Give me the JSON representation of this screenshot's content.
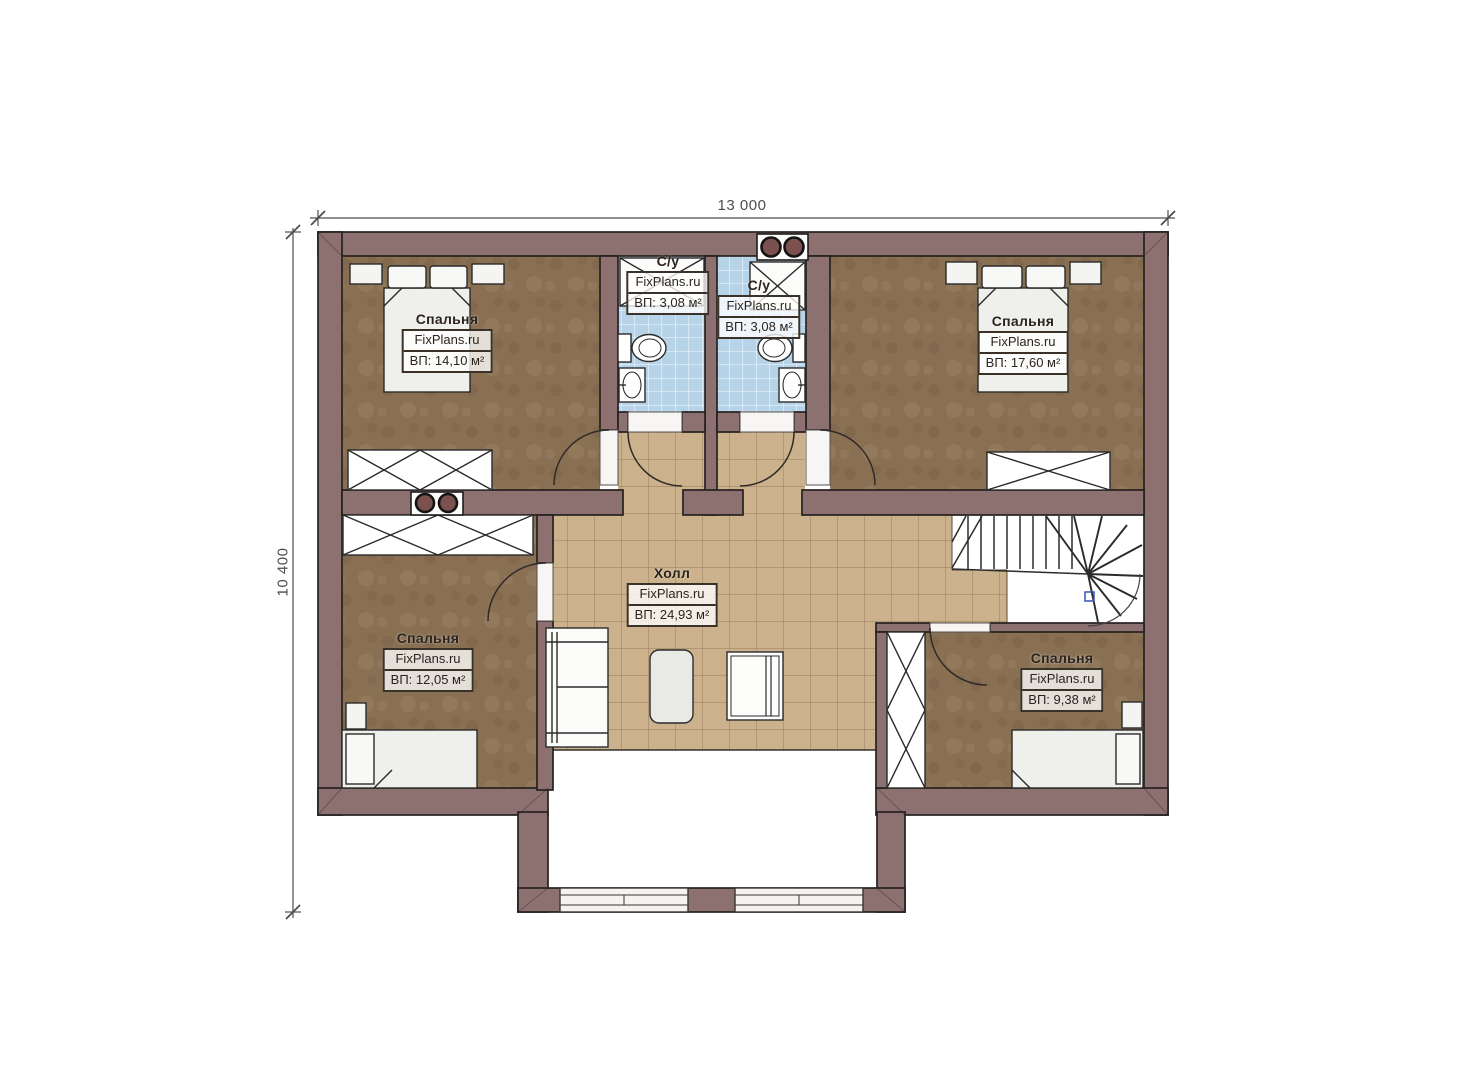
{
  "dimensions": {
    "width": "13 000",
    "height": "10 400"
  },
  "rooms": [
    {
      "id": "bedroom-top-left",
      "name": "Спальня",
      "brand": "FixPlans.ru",
      "area": "ВП: 14,10 м²"
    },
    {
      "id": "bathroom-left",
      "name": "С/у",
      "brand": "FixPlans.ru",
      "area": "ВП: 3,08 м²"
    },
    {
      "id": "bathroom-right",
      "name": "С/у",
      "brand": "FixPlans.ru",
      "area": "ВП: 3,08 м²"
    },
    {
      "id": "bedroom-top-right",
      "name": "Спальня",
      "brand": "FixPlans.ru",
      "area": "ВП: 17,60 м²"
    },
    {
      "id": "hall",
      "name": "Холл",
      "brand": "FixPlans.ru",
      "area": "ВП: 24,93 м²"
    },
    {
      "id": "bedroom-bottom-left",
      "name": "Спальня",
      "brand": "FixPlans.ru",
      "area": "ВП: 12,05 м²"
    },
    {
      "id": "bedroom-bottom-right",
      "name": "Спальня",
      "brand": "FixPlans.ru",
      "area": "ВП: 9,38 м²"
    }
  ],
  "colors": {
    "wall": "#8c7170",
    "outline": "#262020",
    "bedroom_floor": "#8a7053",
    "hall_tile": "#ccb28c",
    "bath_tile": "#b7d3e8",
    "chimney_circle": "#7b5150"
  }
}
